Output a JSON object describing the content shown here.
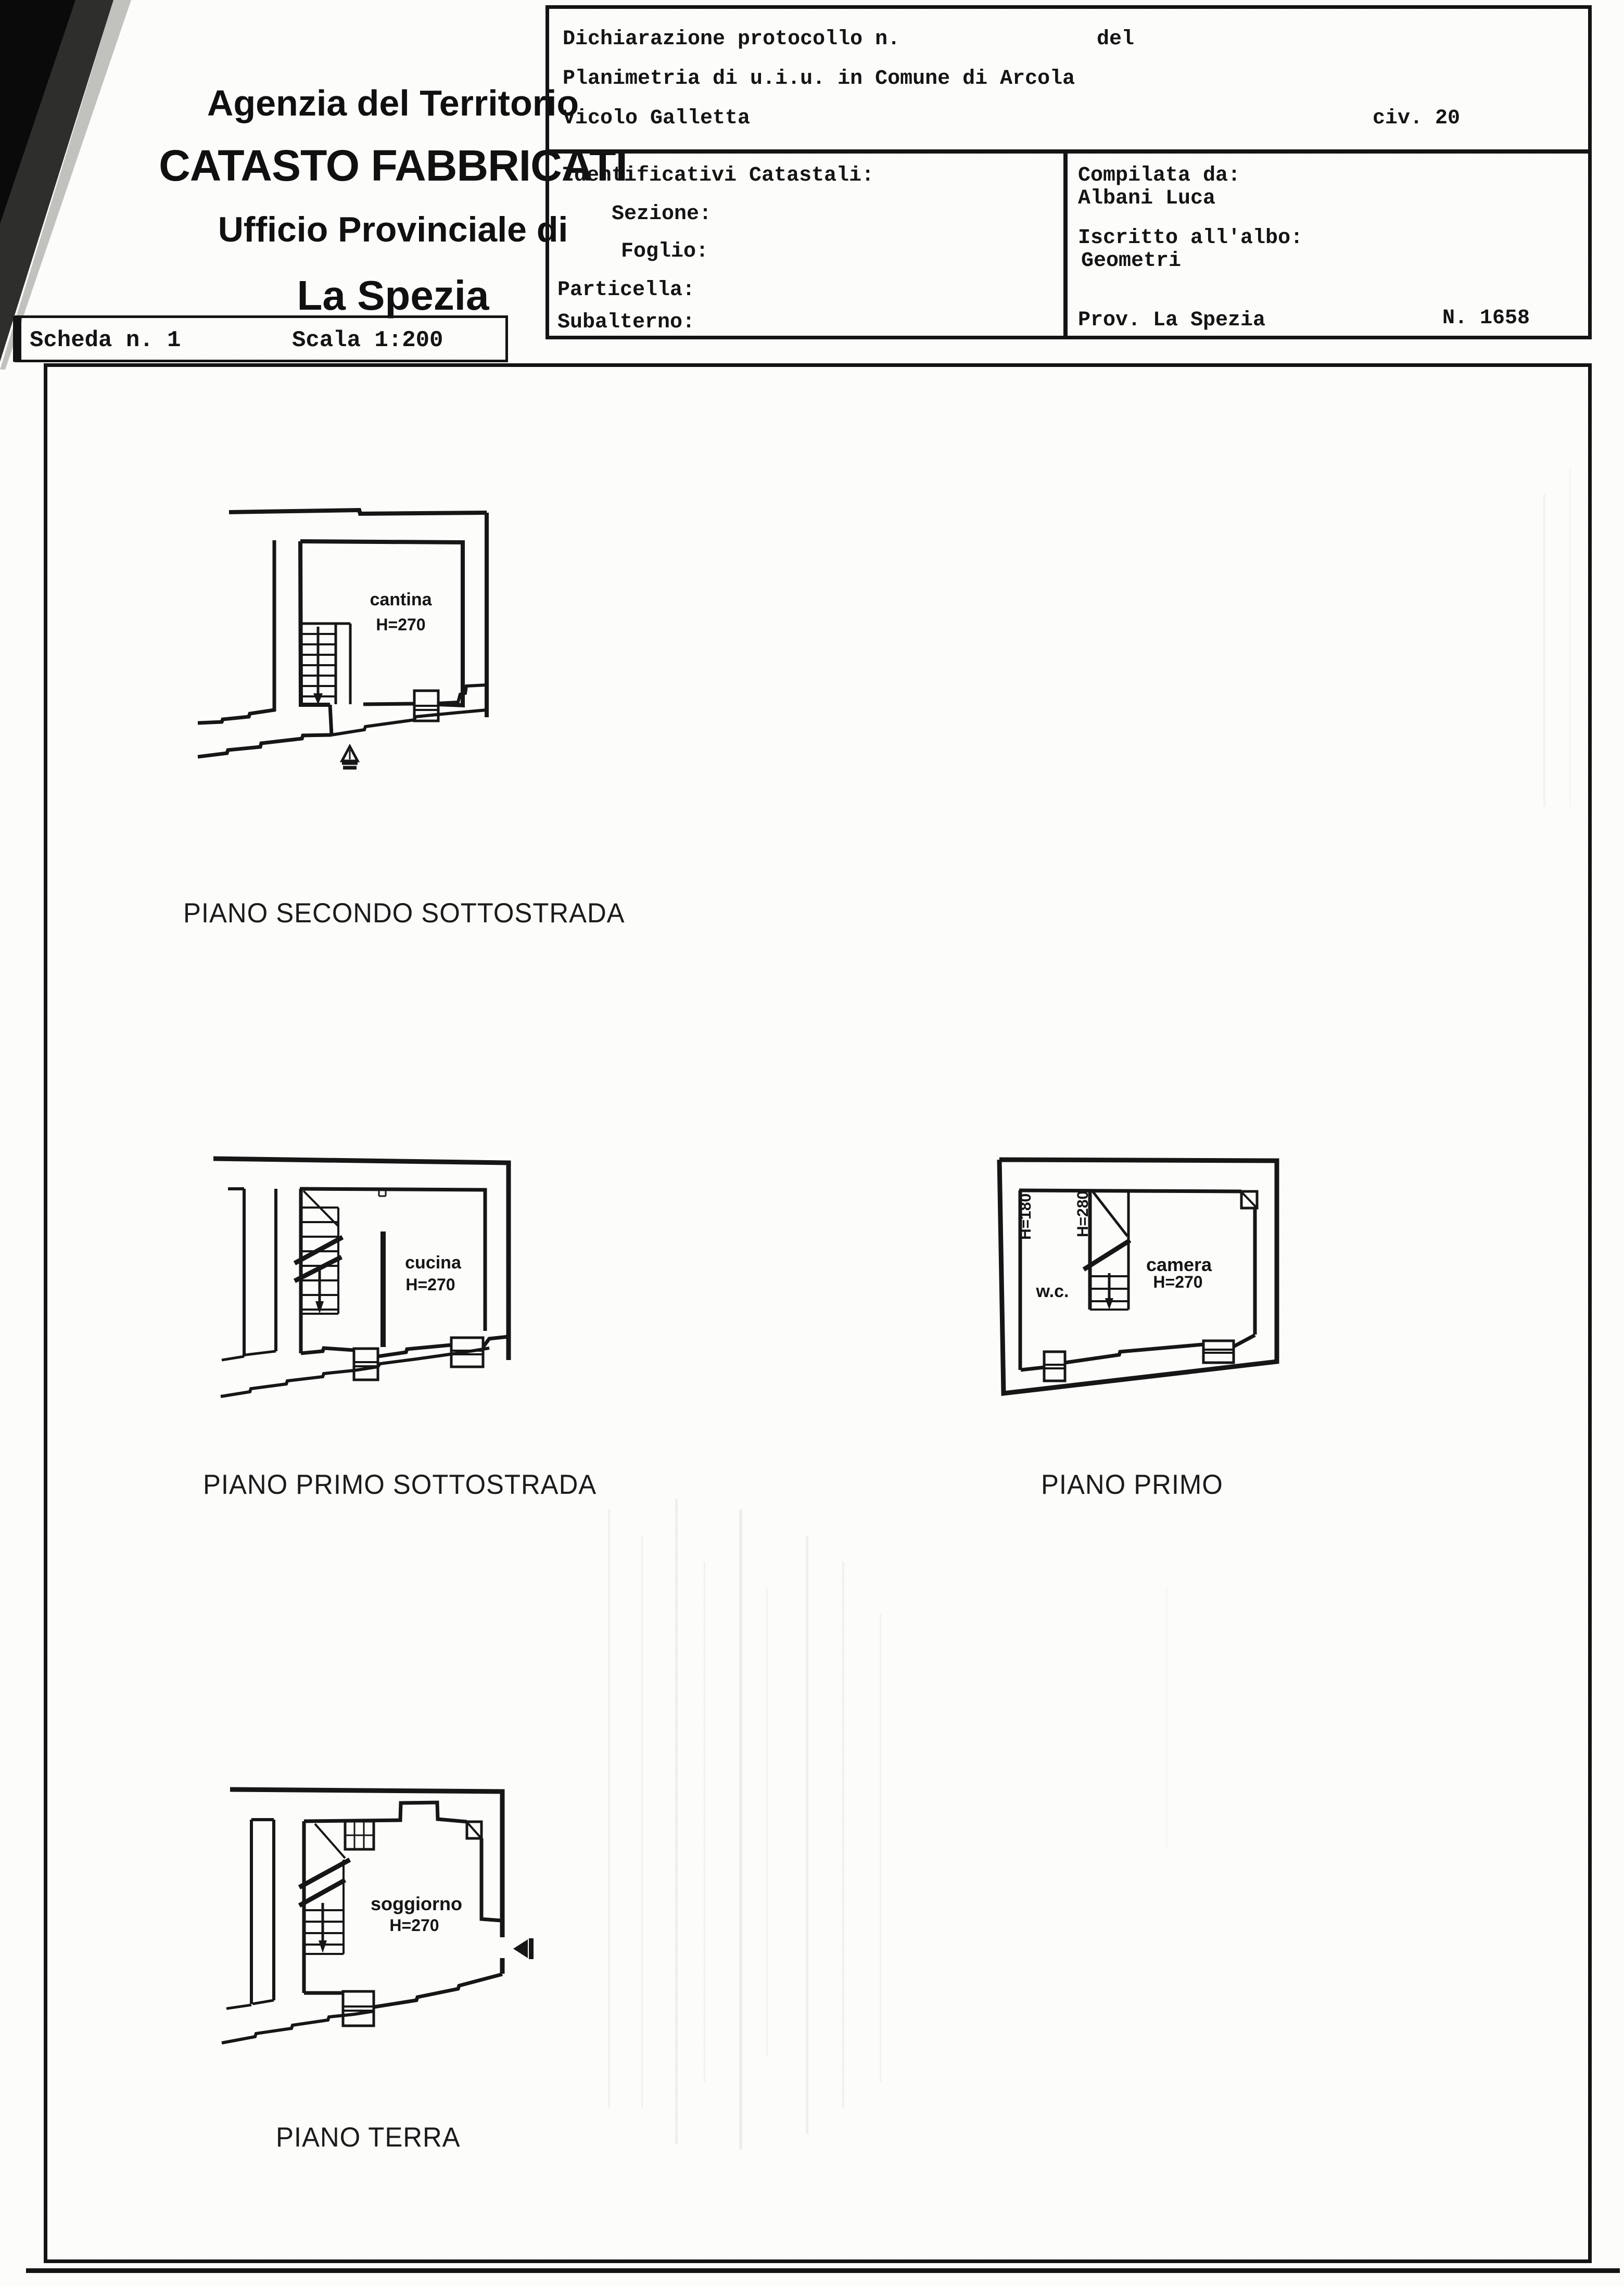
{
  "colors": {
    "ink": "#161616",
    "paper": "#fcfcfa"
  },
  "header": {
    "agency_line1": "Agenzia del Territorio",
    "agency_line2": "CATASTO FABBRICATI",
    "agency_line3": "Ufficio Provinciale di",
    "agency_line4": "La Spezia",
    "scheda": "Scheda n. 1",
    "scala": "Scala 1:200"
  },
  "declaration": {
    "protocol_label": "Dichiarazione protocollo n.",
    "protocol_del": "del",
    "planimetria_line": "Planimetria di u.i.u. in Comune di Arcola",
    "street": "Vicolo Galletta",
    "civic": "civ. 20",
    "identificativi_title": "Identificativi Catastali:",
    "fields": [
      {
        "label": "Sezione:"
      },
      {
        "label": "Foglio:"
      },
      {
        "label": "Particella:"
      },
      {
        "label": "Subalterno:"
      }
    ],
    "compilata_label": "Compilata da:",
    "compilata_name": "Albani Luca",
    "albo_label": "Iscritto all'albo:",
    "albo_value": "Geometri",
    "prov": "Prov. La Spezia",
    "albo_number": "N. 1658"
  },
  "plans": [
    {
      "floor_label": "PIANO SECONDO SOTTOSTRADA",
      "room_name": "cantina",
      "room_height": "H=270"
    },
    {
      "floor_label": "PIANO PRIMO SOTTOSTRADA",
      "room_name": "cucina",
      "room_height": "H=270"
    },
    {
      "floor_label": "PIANO PRIMO",
      "room_name": "camera",
      "room_height": "H=270",
      "room2_name": "w.c.",
      "wall_height_left": "H=180",
      "wall_height_mid": "H=280"
    },
    {
      "floor_label": "PIANO TERRA",
      "room_name": "soggiorno",
      "room_height": "H=270"
    }
  ]
}
